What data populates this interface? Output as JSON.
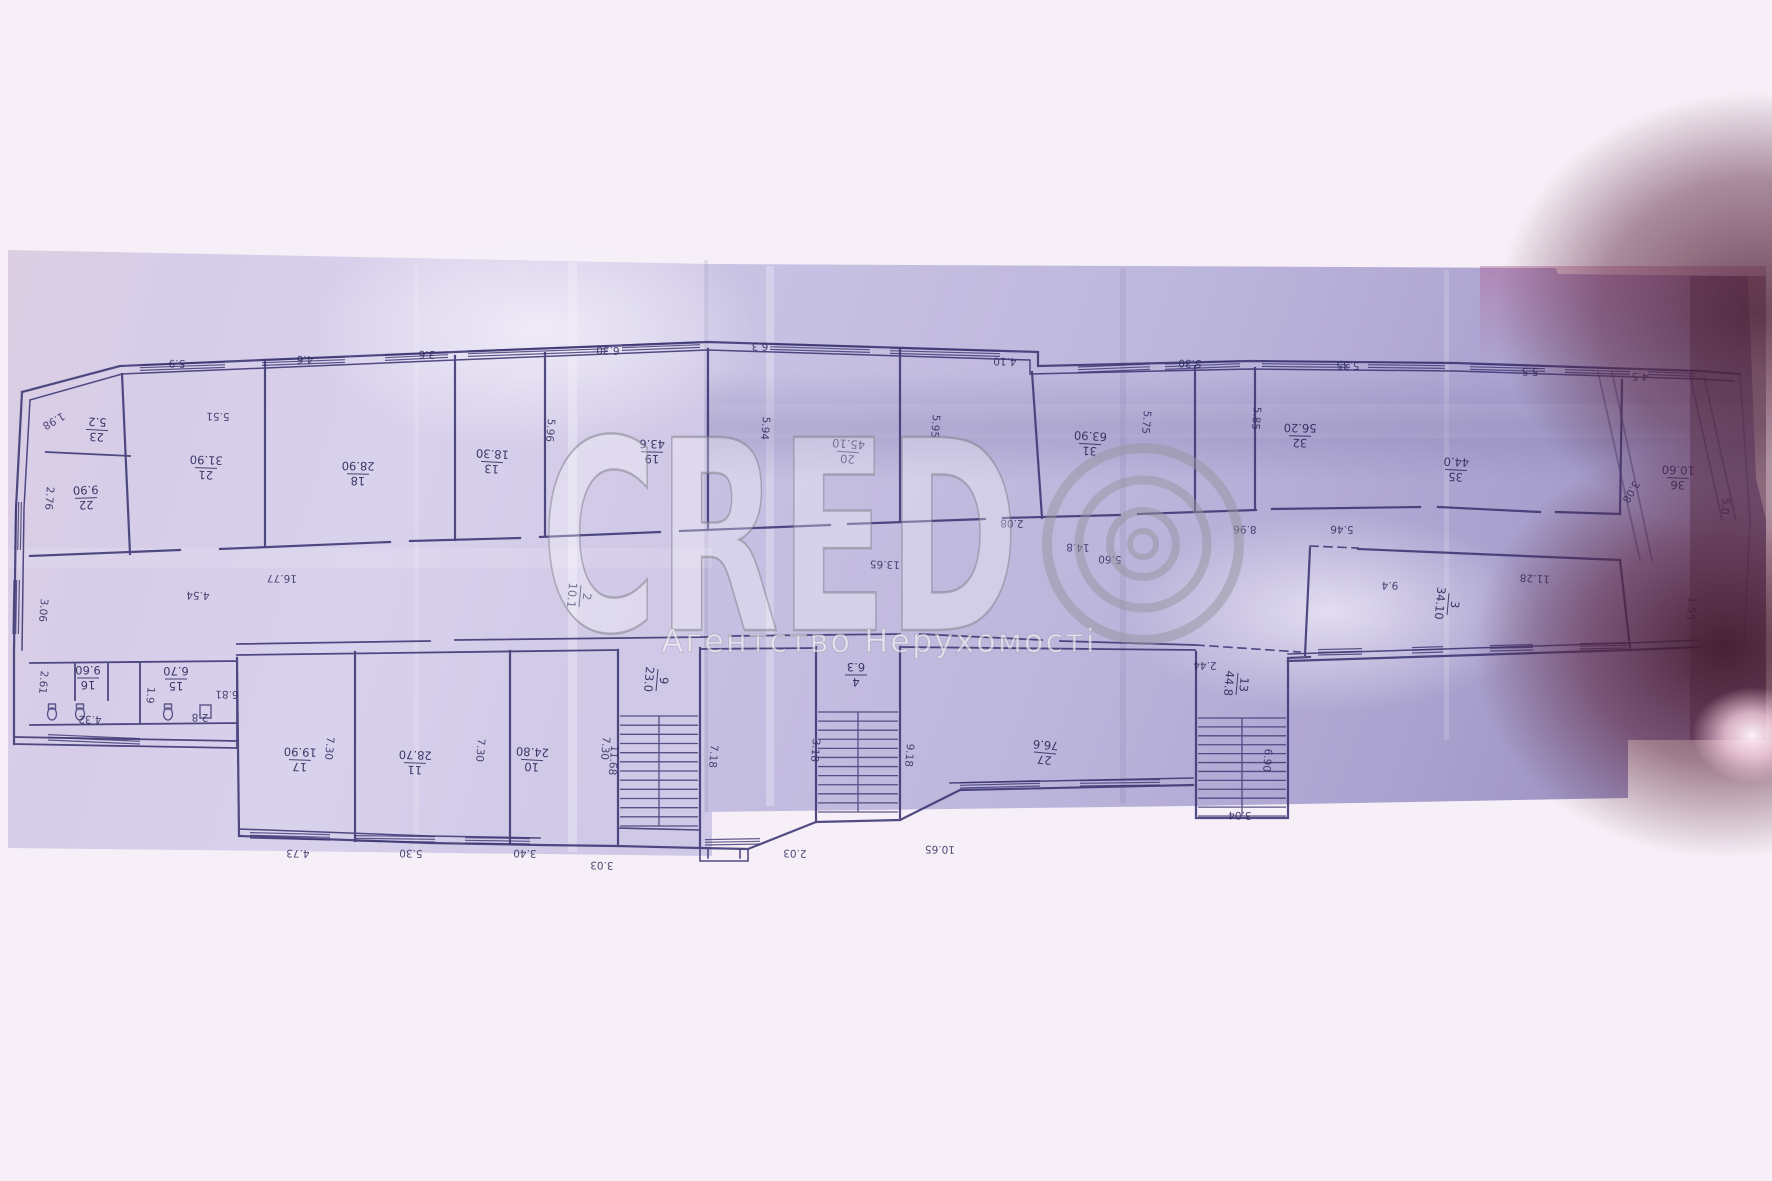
{
  "watermark": {
    "brand": "CRED",
    "ring_symbol": "©",
    "subtitle": "Агентство Нерухомості"
  },
  "plan": {
    "rooms": [
      {
        "num": "23",
        "area": "5.2"
      },
      {
        "num": "22",
        "area": "9.90"
      },
      {
        "num": "21",
        "area": "31.90"
      },
      {
        "num": "18",
        "area": "28.90"
      },
      {
        "num": "13",
        "area": "18.30"
      },
      {
        "num": "19",
        "area": "43.6"
      },
      {
        "num": "20",
        "area": "45.10"
      },
      {
        "num": "31",
        "area": "63.90"
      },
      {
        "num": "32",
        "area": "56.20"
      },
      {
        "num": "35",
        "area": "44.0"
      },
      {
        "num": "36",
        "area": "10.60"
      },
      {
        "num": "2",
        "area": "10.1"
      },
      {
        "num": "3",
        "area": "34.10"
      },
      {
        "num": "16",
        "area": "9.60"
      },
      {
        "num": "15",
        "area": "6.70"
      },
      {
        "num": "17",
        "area": "19.90"
      },
      {
        "num": "11",
        "area": "28.70"
      },
      {
        "num": "10",
        "area": "24.80"
      },
      {
        "num": "9",
        "area": "23.0"
      },
      {
        "num": "4",
        "area": "6.3"
      },
      {
        "num": "27",
        "area": "76.6"
      },
      {
        "num": "13",
        "area": "44.8"
      }
    ],
    "dims": [
      "5.9",
      "4.6",
      "3.6",
      "6.30",
      "6.3",
      "5.51",
      "4.10",
      "5.30",
      "5.35",
      "5.5",
      "4.5",
      "2.76",
      "5.96",
      "5.94",
      "5.95",
      "5.75",
      "5.85",
      "3.08",
      "5.0",
      "1.55",
      "16.77",
      "13.65",
      "2.08",
      "14.8",
      "5.60",
      "8.96",
      "5.46",
      "11.28",
      "2.44",
      "9.4",
      "2.61",
      "4.32",
      "1.9",
      "6.81",
      "2.8",
      "3.06",
      "1.98",
      "4.54",
      "7.30",
      "7.30",
      "7.30",
      "4.73",
      "5.30",
      "3.40",
      "3.03",
      "2.03",
      "9.18",
      "3.18",
      "10.65",
      "11.68",
      "7.18",
      "6.90",
      "3.04"
    ]
  },
  "colors": {
    "page_bg": "#f6eff7",
    "paper_left": "#d6cde8",
    "paper_right": "#bdb6dc",
    "ink": "#3b3672",
    "label_ink": "#2e2a5c",
    "shadow_maroon": "#4a1f33",
    "flare_pink": "#ffe9f2",
    "watermark_gray": "#8a8890"
  }
}
